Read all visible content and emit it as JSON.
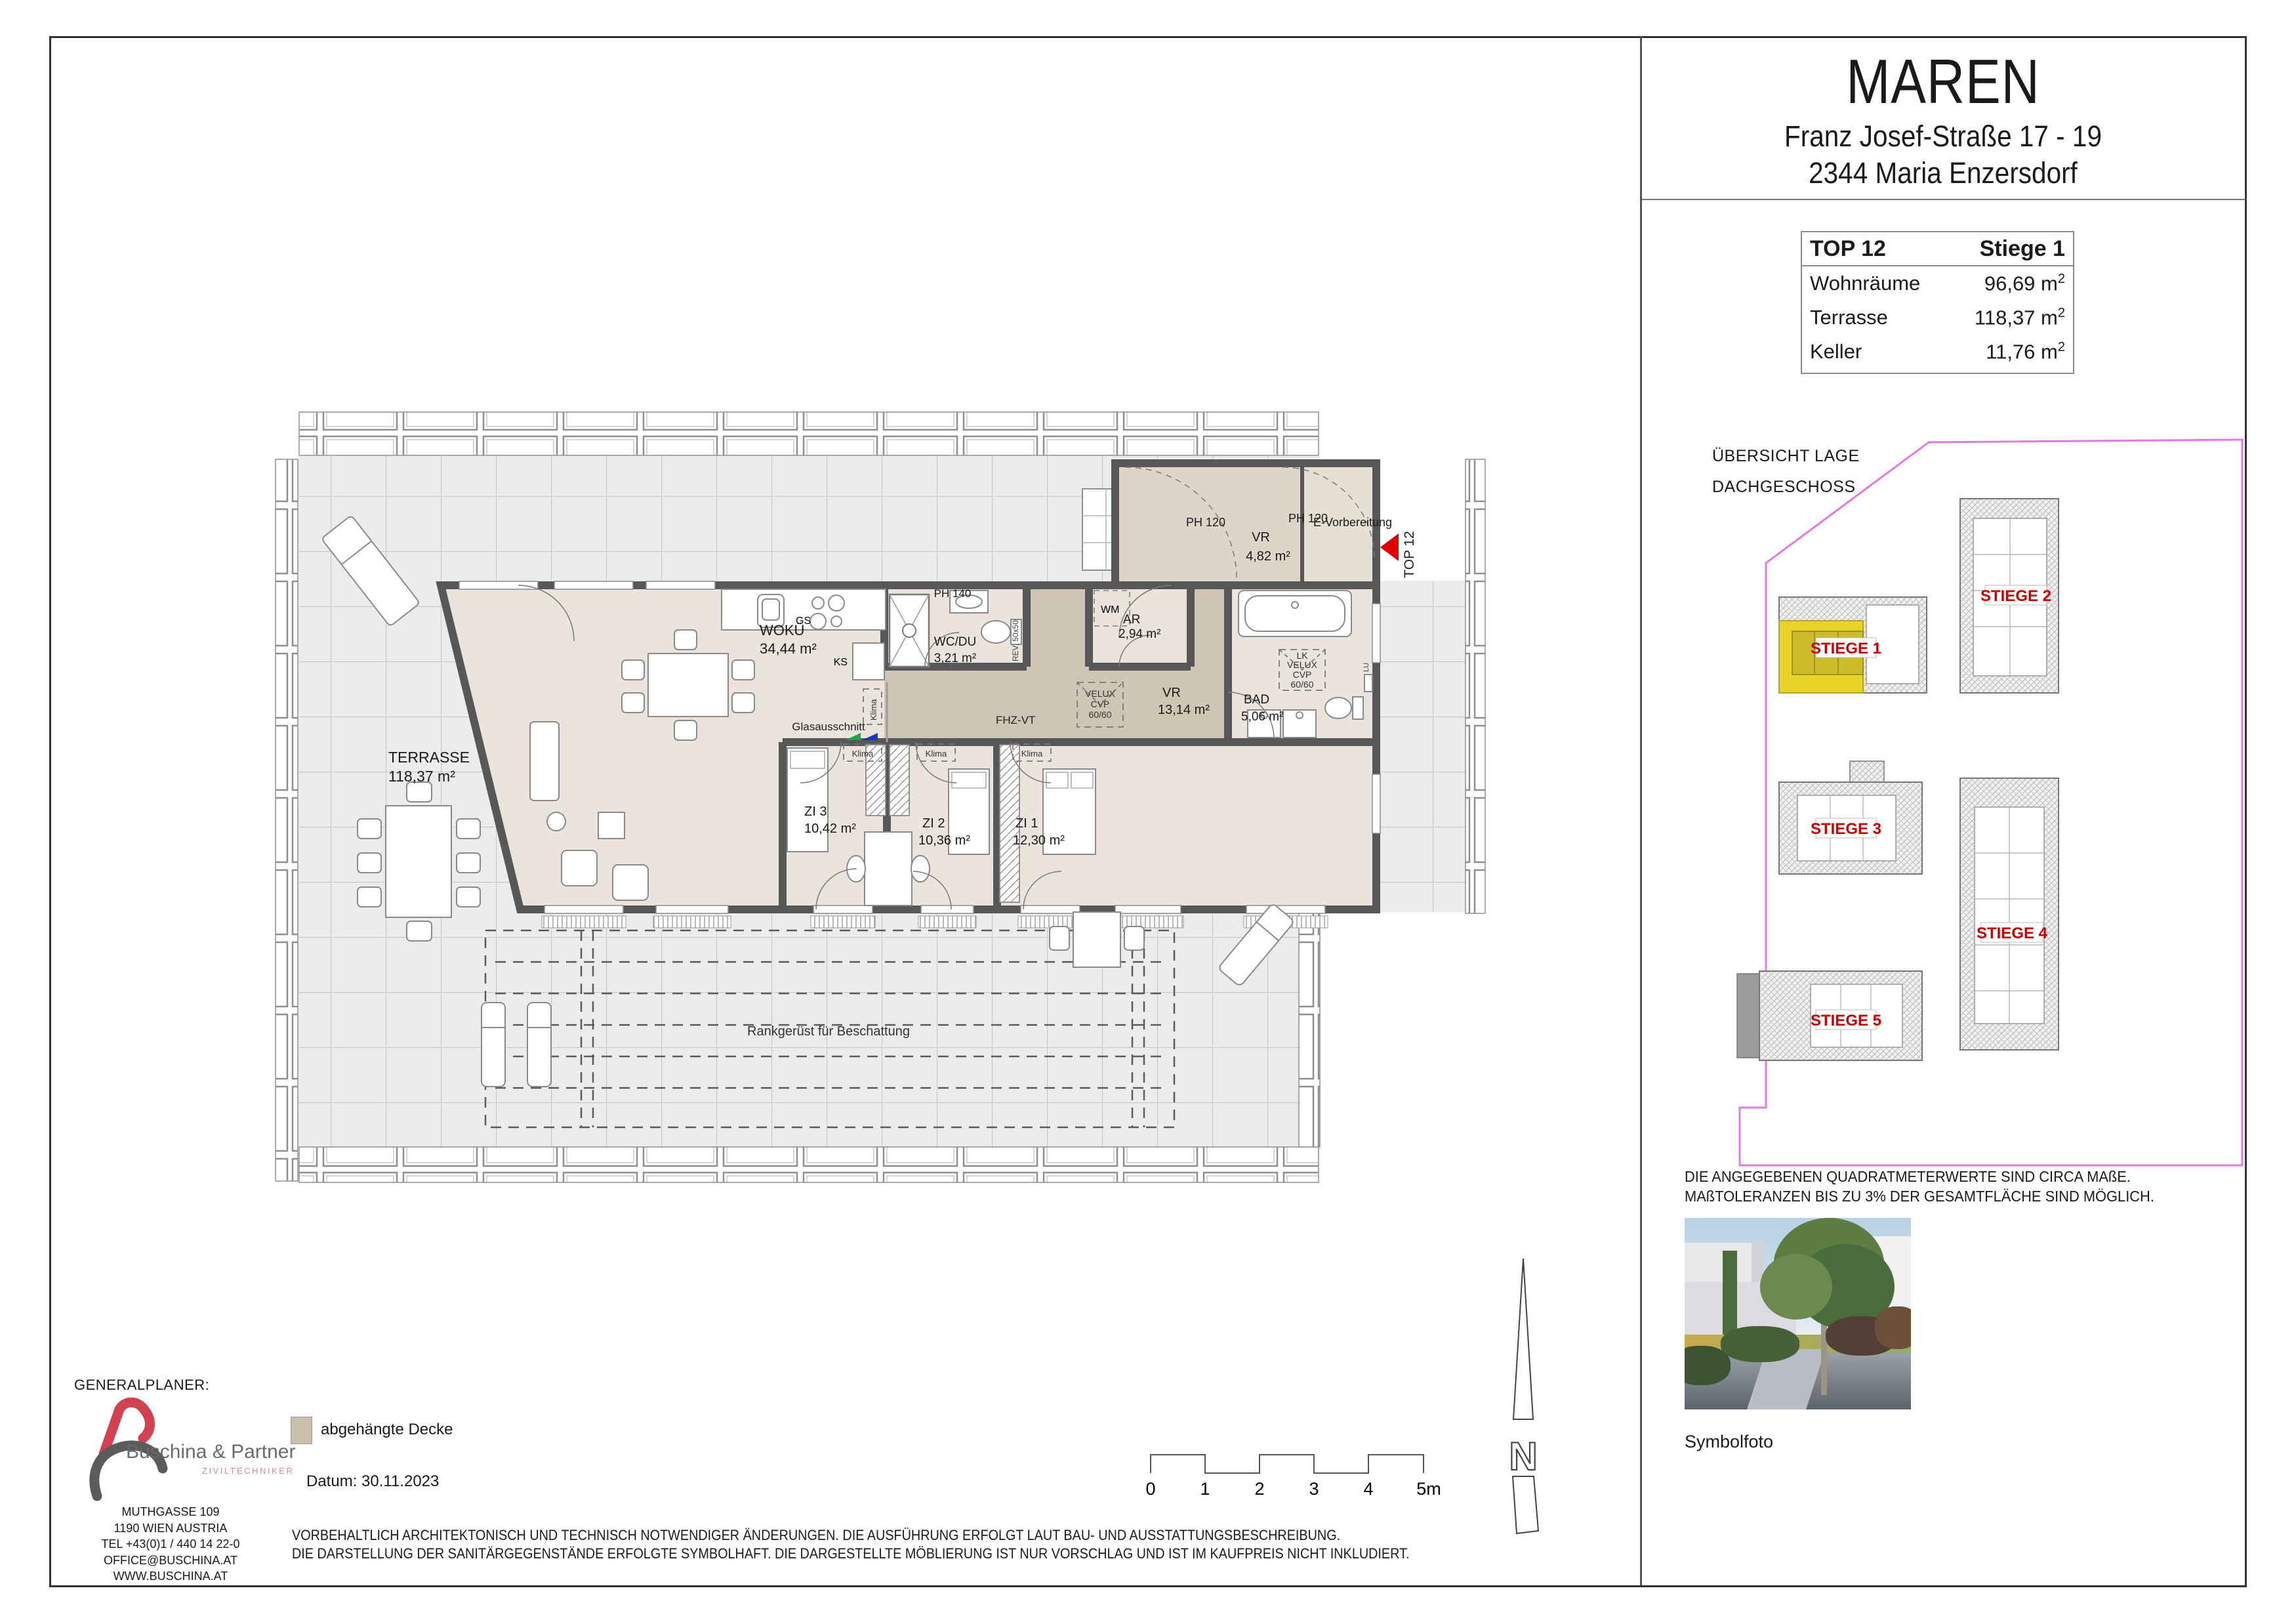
{
  "header": {
    "project": "MAREN",
    "address_line1": "Franz Josef-Straße 17 - 19",
    "address_line2": "2344  Maria Enzersdorf"
  },
  "unit_table": {
    "top": "TOP 12",
    "stiege": "Stiege 1",
    "unit": "m",
    "sup": "2",
    "rows": [
      {
        "label": "Wohnräume",
        "value": "96,69"
      },
      {
        "label": "Terrasse",
        "value": "118,37"
      },
      {
        "label": "Keller",
        "value": "11,76"
      }
    ]
  },
  "site": {
    "title_line1": "ÜBERSICHT LAGE",
    "title_line2": "DACHGESCHOSS",
    "stiege_labels": [
      "STIEGE 1",
      "STIEGE 2",
      "STIEGE 3",
      "STIEGE 4",
      "STIEGE 5"
    ],
    "highlight_color": "#e9d429",
    "label_color": "#cc0000",
    "boundary_color": "#e478e4"
  },
  "plan": {
    "terrasse": {
      "name": "TERRASSE",
      "area": "118,37 m²"
    },
    "wokue": {
      "name": "WOKÜ",
      "area": "34,44 m²"
    },
    "wcdu": {
      "name": "WC/DU",
      "area": "3,21 m²"
    },
    "vr_klein": {
      "name": "VR",
      "area": "4,82 m²"
    },
    "vr": {
      "name": "VR",
      "area": "13,14 m²"
    },
    "ar": {
      "name": "AR",
      "area": "2,94 m²"
    },
    "bad": {
      "name": "BAD",
      "area": "5,06 m²"
    },
    "zi1": {
      "name": "ZI 1",
      "area": "12,30 m²"
    },
    "zi2": {
      "name": "ZI 2",
      "area": "10,36 m²"
    },
    "zi3": {
      "name": "ZI 3",
      "area": "10,42 m²"
    },
    "ph120": "PH 120",
    "ph140": "PH 140",
    "evorbereitung": "E-Vorbereitung",
    "top12": "TOP 12",
    "wm": "WM",
    "gs": "GS",
    "ks": "KS",
    "klima": "Klima",
    "glasausschnitt": "Glasausschnitt",
    "fhzvt": "FHZ-VT",
    "rev": "REV. 50x50",
    "lu": "LU",
    "lk": "LK",
    "velux": [
      "VELUX",
      "CVP",
      "60/60"
    ],
    "rankgeruest": "Rankgerüst für Beschattung"
  },
  "notes": {
    "right_line1": "DIE ANGEGEBENEN QUADRATMETERWERTE SIND CIRCA MAßE.",
    "right_line2": "MAßTOLERANZEN BIS ZU 3% DER GESAMTFLÄCHE SIND MÖGLICH.",
    "bottom_line1": "VORBEHALTLICH ARCHITEKTONISCH UND TECHNISCH NOTWENDIGER ÄNDERUNGEN. DIE AUSFÜHRUNG ERFOLGT LAUT BAU- UND AUSSTATTUNGSBESCHREIBUNG.",
    "bottom_line2": "DIE DARSTELLUNG DER SANITÄRGEGENSTÄNDE ERFOLGTE SYMBOLHAFT. DIE DARGESTELLTE MÖBLIERUNG IST NUR VORSCHLAG UND IST IM KAUFPREIS NICHT INKLUDIERT."
  },
  "symbolfoto": {
    "caption": "Symbolfoto"
  },
  "generalplaner": {
    "heading": "GENERALPLANER:",
    "company": "Buschina & Partner",
    "subtitle": "ZIVILTECHNIKER",
    "address": [
      "MUTHGASSE 109",
      "1190 WIEN  AUSTRIA",
      "TEL +43(0)1 / 440 14 22-0",
      "OFFICE@BUSCHINA.AT",
      "WWW.BUSCHINA.AT"
    ]
  },
  "legend": {
    "swatch_label": "abgehängte Decke",
    "swatch_color": "#c9c0ab",
    "datum": "Datum: 30.11.2023"
  },
  "scalebar": {
    "labels": [
      "0",
      "1",
      "2",
      "3",
      "4",
      "5m"
    ]
  },
  "north": {
    "letter": "N"
  }
}
